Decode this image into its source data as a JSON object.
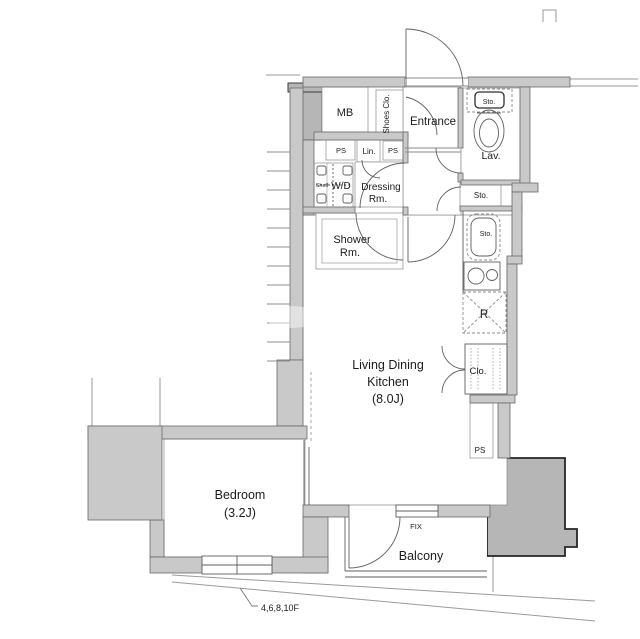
{
  "plan": {
    "labels": {
      "mb": "MB",
      "shoes_closet": "Shoes Clo.",
      "entrance": "Entrance",
      "storage_toilet": "Sto.",
      "lavatory": "Lav.",
      "pipe_space_1": "PS",
      "linen": "Lin.",
      "pipe_space_2": "PS",
      "shelf": "Shelf",
      "washer_dryer": "W/D",
      "dressing_line1": "Dressing",
      "dressing_line2": "Rm.",
      "storage_hall": "Sto.",
      "shower_line1": "Shower",
      "shower_line2": "Rm.",
      "storage_kitchen": "Sto.",
      "refrigerator": "R",
      "ldk_line1": "Living Dining",
      "ldk_line2": "Kitchen",
      "ldk_line3": "(8.0J)",
      "closet": "Clo.",
      "pipe_space_3": "PS",
      "bedroom_line1": "Bedroom",
      "bedroom_line2": "(3.2J)",
      "fix_window": "FIX",
      "balcony": "Balcony",
      "floor_note": "4,6,8,10F"
    },
    "colors": {
      "wall": "#c9c9c9",
      "neighbor": "#b6b6b6",
      "outline": "#5a5a5a"
    }
  }
}
